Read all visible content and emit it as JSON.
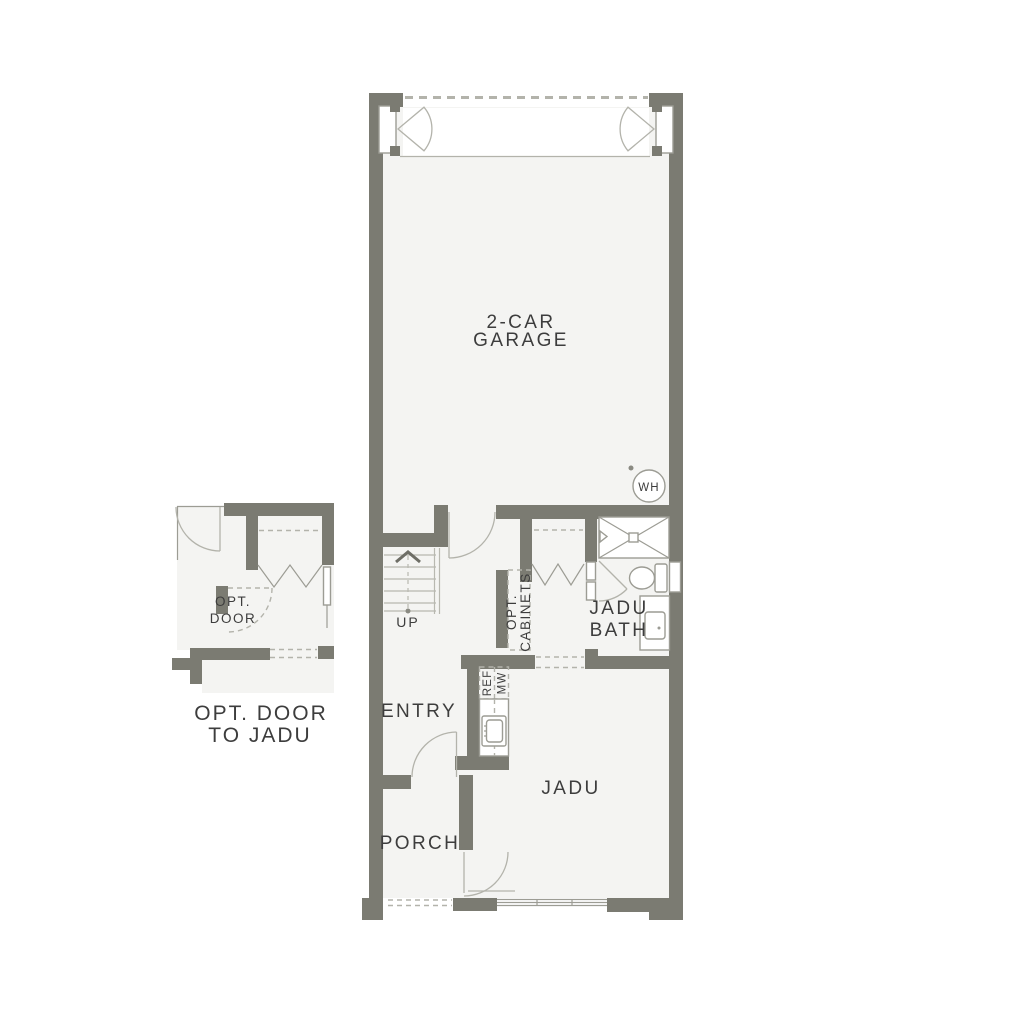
{
  "document": {
    "type": "floor-plan"
  },
  "colors": {
    "wall": "#7b7b72",
    "floor": "#f4f4f2",
    "paper": "#ffffff",
    "line": "#9c9c94",
    "light_line": "#b3b3ab",
    "stair_line": "#b8b8b0",
    "text": "#3d3d3d",
    "dark_accent": "#6e6e66"
  },
  "main_plan": {
    "rooms": {
      "garage": {
        "label_line1": "2-CAR",
        "label_line2": "GARAGE"
      },
      "entry": {
        "label": "ENTRY"
      },
      "porch": {
        "label": "PORCH"
      },
      "jadu": {
        "label": "JADU"
      },
      "jadu_bath": {
        "label_line1": "JADU",
        "label_line2": "BATH"
      }
    },
    "annotations": {
      "stairs_direction": "UP",
      "water_heater": "WH",
      "opt_cabinets_line1": "OPT.",
      "opt_cabinets_line2": "CABINETS",
      "refrigerator": "REF",
      "microwave": "MW"
    }
  },
  "detail_plan": {
    "door_label_line1": "OPT.",
    "door_label_line2": "DOOR",
    "caption_line1": "OPT. DOOR",
    "caption_line2": "TO JADU"
  }
}
